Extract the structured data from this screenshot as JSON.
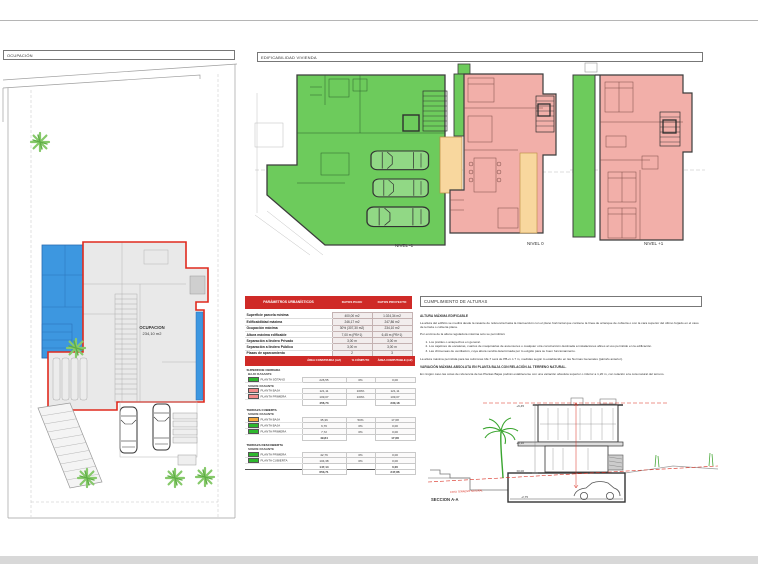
{
  "sections": {
    "ocupacion": "OCUPACIÓN",
    "edificabilidad": "EDIFICABILIDAD VIVIENDA",
    "cumplimiento": "CUMPLIMIENTO DE ALTURAS"
  },
  "site_plan": {
    "occupation_label": "OCUPACION",
    "occupation_area": "234,10 m2"
  },
  "floor_plans": [
    {
      "label": "NIVEL -1"
    },
    {
      "label": "NIVEL 0"
    },
    {
      "label": "NIVEL +1"
    }
  ],
  "tables": {
    "parametros": {
      "title": "PARÁMETROS URBANÍSTICOS",
      "col1": "DATOS PGOU",
      "col2": "DATOS PROYECTO",
      "rows": [
        {
          "label": "Superficie parcela mínima",
          "pgou": "400,00 m2",
          "proyecto": "1.024,34 m2"
        },
        {
          "label": "Edificabilidad máxima",
          "pgou": "246,17 m2",
          "proyecto": "247,86 m2"
        },
        {
          "label": "Ocupación máxima",
          "pgou": "30% (307,30 m2)",
          "proyecto": "234,10 m2"
        },
        {
          "label": "Altura máxima edificable",
          "pgou": "7,00 m (PB+1)",
          "proyecto": "6,45 m (PB+1)"
        },
        {
          "label": "Separación a lindero Privado",
          "pgou": "3,00 m",
          "proyecto": "3,00 m"
        },
        {
          "label": "Separación a lindero Público",
          "pgou": "3,00 m",
          "proyecto": "3,00 m"
        },
        {
          "label": "Plazas de aparcamiento",
          "pgou": "2",
          "proyecto": "3"
        }
      ]
    },
    "superficies": {
      "col_area": "ÁREA CONSTRUIDA (m2)",
      "col_computo": "% CÓMPUTO",
      "col_computable": "ÁREA COMPUTABLE (m2)",
      "rows": [
        {
          "type": "section",
          "label": "SUPERFICIE CERRADA"
        },
        {
          "type": "sub",
          "label": "BAJO RASANTE"
        },
        {
          "type": "data",
          "swatch": "#2eb82e",
          "label": "PLANTA SÓTANO",
          "area": "226,55",
          "computo": "0%",
          "computable": "0,00"
        },
        {
          "type": "sub",
          "label": "SOBRE RASANTE"
        },
        {
          "type": "data",
          "swatch": "#f28a8a",
          "label": "PLANTA BAJA",
          "area": "121,11",
          "computo": "100%",
          "computable": "121,11"
        },
        {
          "type": "data",
          "swatch": "#f28a8a",
          "label": "PLANTA PRIMERA",
          "area": "109,07",
          "computo": "100%",
          "computable": "109,07"
        },
        {
          "type": "subtotal",
          "area": "456,73",
          "computable": "230,18"
        },
        {
          "type": "section",
          "label": "TERRAZA CUBIERTA"
        },
        {
          "type": "sub",
          "label": "SOBRE RASANTE"
        },
        {
          "type": "data",
          "swatch": "#f5a93f",
          "label": "PLANTA BAJA",
          "area": "35,36",
          "computo": "50%",
          "computable": "17,68"
        },
        {
          "type": "data",
          "swatch": "#2eb82e",
          "label": "PLANTA BAJA",
          "area": "6,76",
          "computo": "0%",
          "computable": "0,00"
        },
        {
          "type": "data",
          "swatch": "#2eb82e",
          "label": "PLANTA PRIMERA",
          "area": "7,72",
          "computo": "0%",
          "computable": "0,00"
        },
        {
          "type": "subtotal",
          "area": "49,84",
          "computable": "17,68"
        },
        {
          "type": "section",
          "label": "TERRAZA DESCUBIERTA"
        },
        {
          "type": "sub",
          "label": "SOBRE RASANTE"
        },
        {
          "type": "data",
          "swatch": "#2eb82e",
          "label": "PLANTA PRIMERA",
          "area": "42,76",
          "computo": "0%",
          "computable": "0,00"
        },
        {
          "type": "data",
          "swatch": "#2eb82e",
          "label": "PLANTA CUBIERTA",
          "area": "104,38",
          "computo": "0%",
          "computable": "0,00"
        },
        {
          "type": "subtotal",
          "area": "147,14",
          "computable": "0,00"
        },
        {
          "type": "total",
          "area": "653,71",
          "computable": "247,86"
        }
      ]
    }
  },
  "alturas": {
    "heading": "ALTURA MÁXIMA EDIFICABLE",
    "p1": "La altura del edificio se medirá desde la rasante de referencia hasta la intersección con el plano horizontal que contiene la línea de arranque de cubierta o con la cara superior del último forjado en el caso de terraza o cubierta plana.",
    "p2": "Por encima de la altura reguladora máxima solo se permitirán:",
    "list": [
      "Los pretiles o antepechos en general.",
      "Los cajetines de escaleras, cuartos de maquinarias de ascensores o cualquier otra construcción destinada a instalaciones afines al uso permitido en la edificación.",
      "Las chimeneas de ventilación, cuya altura vendrá determinada por lo exigido para su buen funcionamiento."
    ],
    "p3": "La altura máxima permitida para las subzonas UE-7 será de PB+1 ó 7 m, medidas según lo establecido en las Normas Generales (párrafo anterior).",
    "heading2": "VARIACIÓN MÁXIMA ABSOLUTA EN PLANTA BAJA CON RELACIÓN AL TERRENO NATURAL.",
    "p4": "En ningún caso las cotas de referencia de las Plantas Bajas podrán establecerse con una variación absoluta superior o inferior a 1,20 m, con relación a la cota natural del terreno."
  },
  "seccion": {
    "label": "SECCION A-A",
    "cota_text": "COTA TERRENO NATURAL",
    "levels": [
      "+6,45",
      "+3,10",
      "±0,00",
      "-2,75"
    ]
  },
  "colors": {
    "table_header_red": "#cf2a27",
    "footprint_outline_red": "#e02a1e",
    "plan_green": "#6dcb5c",
    "plan_pink": "#f2afa9",
    "plan_tan": "#f8d79e",
    "pool_blue": "#3d97e0",
    "swatch_green": "#2eb82e",
    "swatch_pink": "#f28a8a",
    "swatch_orange": "#f5a93f"
  }
}
